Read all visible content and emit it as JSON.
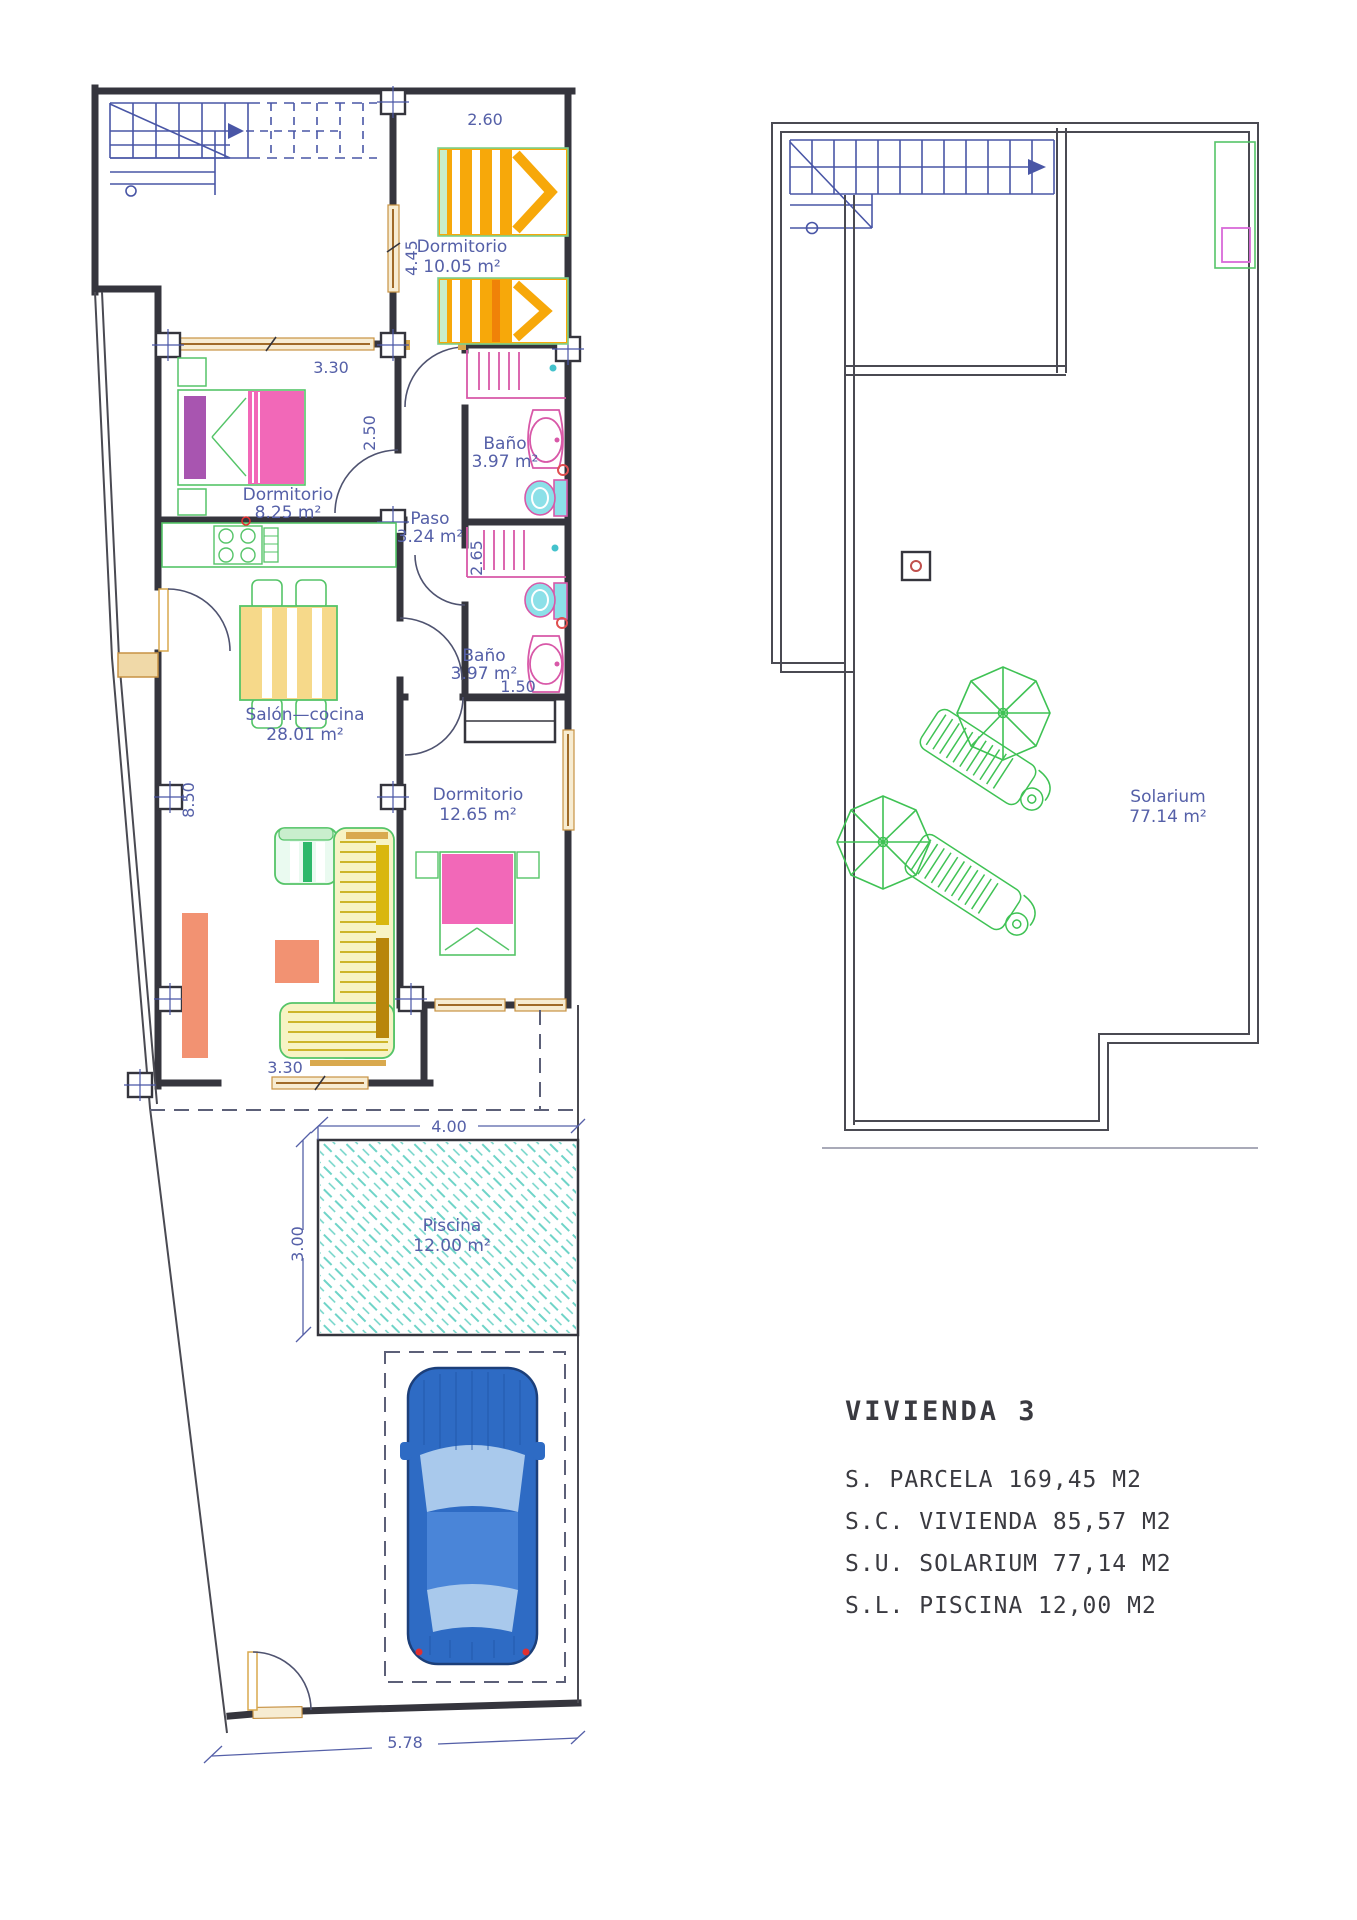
{
  "legend": {
    "title": "VIVIENDA 3",
    "lines": [
      "S. PARCELA 169,45 M2",
      "S.C. VIVIENDA 85,57 M2",
      "S.U. SOLARIUM 77,14 M2",
      "S.L. PISCINA 12,00 M2"
    ]
  },
  "rooms": {
    "dormitorio1": {
      "name": "Dormitorio",
      "area": "10.05 m²"
    },
    "dormitorio2": {
      "name": "Dormitorio",
      "area": "8.25 m²"
    },
    "dormitorio3": {
      "name": "Dormitorio",
      "area": "12.65 m²"
    },
    "bano1": {
      "name": "Baño",
      "area": "3.97 m²"
    },
    "bano2": {
      "name": "Baño",
      "area": "3.97 m²"
    },
    "paso": {
      "name": "Paso",
      "area": "3.24 m²"
    },
    "salon": {
      "name": "Salón—cocina",
      "area": "28.01 m²"
    },
    "solarium": {
      "name": "Solarium",
      "area": "77.14 m²"
    },
    "piscina": {
      "name": "Piscina",
      "area": "12.00 m²"
    }
  },
  "dimensions": {
    "w260": "2.60",
    "h445": "4.45",
    "w330": "3.30",
    "h250": "2.50",
    "h265": "2.65",
    "w150": "1.50",
    "h850": "8.50",
    "w330b": "3.30",
    "w400": "4.00",
    "h300": "3.00",
    "w578": "5.78"
  },
  "colors": {
    "wall": "#35353d",
    "label_blue": "#5560a8",
    "stairs_blue": "#4956a6",
    "window_tan": "#c79244",
    "furniture_green": "#55c468",
    "bed_orange": "#f7a80a",
    "bed_pink": "#f268b8",
    "pillow_purple": "#a855b0",
    "table_yellow": "#f6d98a",
    "sofa_cushion": "#d9b70e",
    "salmon": "#f29272",
    "pool_teal": "#6fd4c8",
    "toilet_cyan": "#8ce0e8",
    "fixture_pink": "#d858a8",
    "car_blue": "#2e6bc4",
    "legend_text": "#3a3a40"
  }
}
